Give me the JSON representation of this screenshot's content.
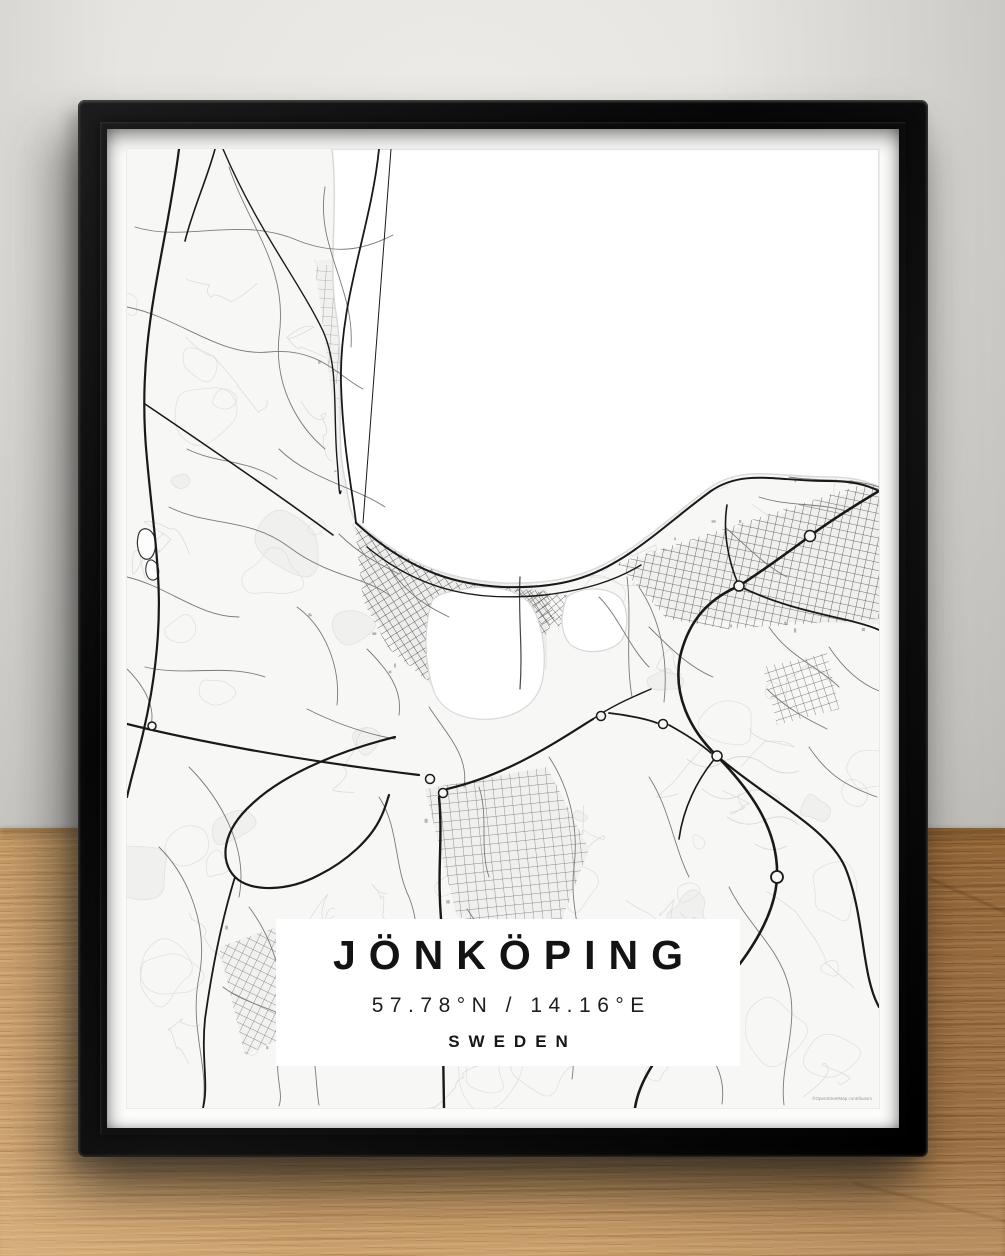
{
  "poster": {
    "title": "JÖNKÖPING",
    "coordinates": "57.78°N / 14.16°E",
    "country": "SWEDEN",
    "attribution": "©OpenStreetMap contributors"
  },
  "colors": {
    "frame": "#0c0c0c",
    "mat": "#fcfcfb",
    "map_land": "#f7f7f6",
    "map_water": "#ffffff",
    "road_major": "#191919",
    "road_minor": "#7a7a7a",
    "landuse_outline": "#e1e1e0",
    "wall": "#d9d8d4",
    "wood": "#b2804a",
    "title_text": "#131313"
  }
}
